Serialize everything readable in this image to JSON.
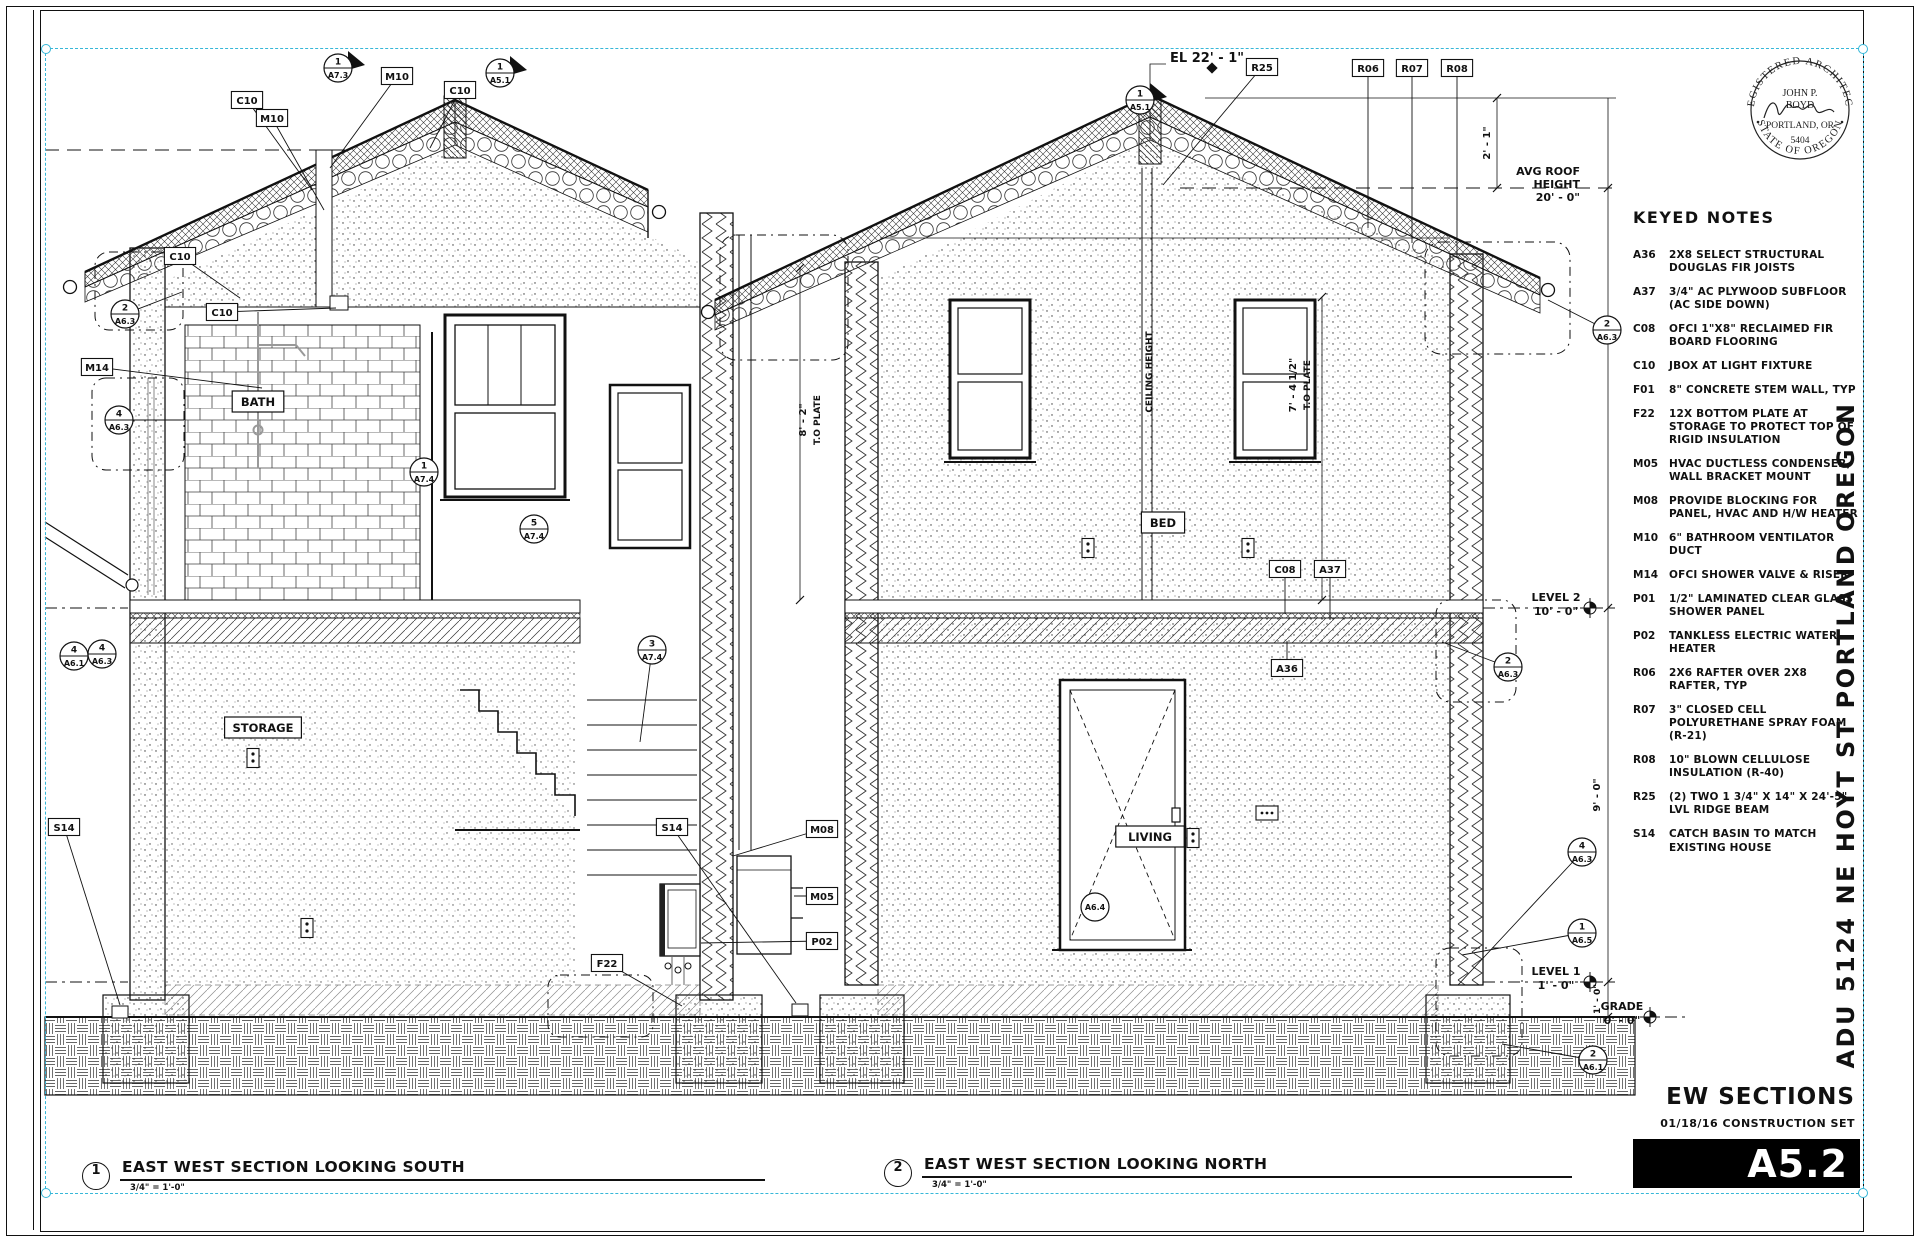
{
  "sheet": {
    "number": "A5.2",
    "title": "EW SECTIONS",
    "set_label": "01/18/16 CONSTRUCTION SET",
    "project_vertical": "ADU 5124 NE HOYT ST PORTLAND OREGON"
  },
  "stamp": {
    "arc_top": "REGISTERED ARCHITECT",
    "arc_bottom": "STATE OF OREGON",
    "name_line1": "JOHN P.",
    "name_line2": "BOYD",
    "city": "PORTLAND, OR",
    "license": "5404"
  },
  "keyed_notes": {
    "title": "KEYED NOTES",
    "notes": [
      {
        "code": "A36",
        "text": "2X8 SELECT STRUCTURAL DOUGLAS FIR JOISTS"
      },
      {
        "code": "A37",
        "text": "3/4\" AC PLYWOOD SUBFLOOR (AC SIDE DOWN)"
      },
      {
        "code": "C08",
        "text": "OFCI 1\"X8\" RECLAIMED FIR BOARD FLOORING"
      },
      {
        "code": "C10",
        "text": "JBOX AT LIGHT FIXTURE"
      },
      {
        "code": "F01",
        "text": "8\" CONCRETE STEM WALL, TYP"
      },
      {
        "code": "F22",
        "text": "12X BOTTOM PLATE AT STORAGE TO PROTECT TOP OF RIGID INSULATION"
      },
      {
        "code": "M05",
        "text": "HVAC DUCTLESS CONDENSER, WALL BRACKET MOUNT"
      },
      {
        "code": "M08",
        "text": "PROVIDE BLOCKING FOR PANEL, HVAC AND H/W HEATER"
      },
      {
        "code": "M10",
        "text": "6\" BATHROOM VENTILATOR DUCT"
      },
      {
        "code": "M14",
        "text": "OFCI SHOWER VALVE & RISER"
      },
      {
        "code": "P01",
        "text": "1/2\" LAMINATED CLEAR GLASS SHOWER PANEL"
      },
      {
        "code": "P02",
        "text": "TANKLESS ELECTRIC WATER HEATER"
      },
      {
        "code": "R06",
        "text": "2X6 RAFTER OVER 2X8 RAFTER, TYP"
      },
      {
        "code": "R07",
        "text": "3\" CLOSED CELL POLYURETHANE SPRAY FOAM (R-21)"
      },
      {
        "code": "R08",
        "text": "10\" BLOWN CELLULOSE INSULATION (R-40)"
      },
      {
        "code": "R25",
        "text": "(2) TWO 1 3/4\" X 14\" X 24'-5\" LVL RIDGE BEAM"
      },
      {
        "code": "S14",
        "text": "CATCH BASIN TO MATCH EXISTING HOUSE"
      }
    ]
  },
  "sections": [
    {
      "num": "1",
      "title": "EAST WEST SECTION LOOKING SOUTH",
      "scale": "3/4\" = 1'-0\""
    },
    {
      "num": "2",
      "title": "EAST WEST SECTION LOOKING NORTH",
      "scale": "3/4\" = 1'-0\""
    }
  ],
  "drawing": {
    "room_labels": [
      {
        "t": "BATH",
        "x": 258,
        "y": 402
      },
      {
        "t": "STORAGE",
        "x": 263,
        "y": 728
      },
      {
        "t": "BED",
        "x": 1163,
        "y": 523
      },
      {
        "t": "LIVING",
        "x": 1150,
        "y": 837
      }
    ],
    "tags": [
      {
        "t": "C10",
        "x": 247,
        "y": 100,
        "lx": 312,
        "ly": 190
      },
      {
        "t": "M10",
        "x": 272,
        "y": 118,
        "lx": 324,
        "ly": 210
      },
      {
        "t": "M10",
        "x": 397,
        "y": 76,
        "lx": 330,
        "ly": 168
      },
      {
        "t": "C10",
        "x": 460,
        "y": 90,
        "lx": 430,
        "ly": 148
      },
      {
        "t": "C10",
        "x": 180,
        "y": 256,
        "lx": 240,
        "ly": 298
      },
      {
        "t": "C10",
        "x": 222,
        "y": 312,
        "lx": 336,
        "ly": 308
      },
      {
        "t": "M14",
        "x": 97,
        "y": 367,
        "lx": 262,
        "ly": 388
      },
      {
        "t": "R25",
        "x": 1262,
        "y": 67,
        "lx": 1163,
        "ly": 185
      },
      {
        "t": "R06",
        "x": 1368,
        "y": 68,
        "lx": 1368,
        "ly": 228
      },
      {
        "t": "R07",
        "x": 1412,
        "y": 68,
        "lx": 1412,
        "ly": 243
      },
      {
        "t": "R08",
        "x": 1457,
        "y": 68,
        "lx": 1457,
        "ly": 258
      },
      {
        "t": "C08",
        "x": 1285,
        "y": 569,
        "lx": 1285,
        "ly": 614
      },
      {
        "t": "A37",
        "x": 1330,
        "y": 569,
        "lx": 1330,
        "ly": 620
      },
      {
        "t": "A36",
        "x": 1287,
        "y": 668,
        "lx": 1287,
        "ly": 641
      },
      {
        "t": "M08",
        "x": 822,
        "y": 829,
        "lx": 733,
        "ly": 856
      },
      {
        "t": "M05",
        "x": 822,
        "y": 896,
        "lx": 794,
        "ly": 896
      },
      {
        "t": "P02",
        "x": 822,
        "y": 941,
        "lx": 701,
        "ly": 943
      },
      {
        "t": "F22",
        "x": 607,
        "y": 963,
        "lx": 682,
        "ly": 1006
      },
      {
        "t": "S14",
        "x": 64,
        "y": 827,
        "lx": 120,
        "ly": 1005
      },
      {
        "t": "S14",
        "x": 672,
        "y": 827,
        "lx": 796,
        "ly": 1003
      }
    ],
    "markers": [
      {
        "n": "1",
        "s": "A7.3",
        "x": 338,
        "y": 68,
        "f": 1
      },
      {
        "n": "1",
        "s": "A5.1",
        "x": 500,
        "y": 73,
        "f": 1
      },
      {
        "n": "1",
        "s": "A5.1",
        "x": 1140,
        "y": 100,
        "f": 1
      },
      {
        "n": "2",
        "s": "A6.3",
        "x": 125,
        "y": 314,
        "lx": 182,
        "ly": 292
      },
      {
        "n": "4",
        "s": "A6.3",
        "x": 119,
        "y": 420,
        "lx": 184,
        "ly": 420
      },
      {
        "n": "4",
        "s": "A6.1",
        "x": 74,
        "y": 656
      },
      {
        "n": "4",
        "s": "A6.3",
        "x": 102,
        "y": 654
      },
      {
        "n": "1",
        "s": "A7.4",
        "x": 424,
        "y": 472
      },
      {
        "n": "5",
        "s": "A7.4",
        "x": 534,
        "y": 529
      },
      {
        "n": "3",
        "s": "A7.4",
        "x": 652,
        "y": 650,
        "lx": 640,
        "ly": 742
      },
      {
        "n": "2",
        "s": "A6.3",
        "x": 1607,
        "y": 330,
        "lx": 1548,
        "ly": 300
      },
      {
        "n": "2",
        "s": "A6.3",
        "x": 1508,
        "y": 667,
        "lx": 1442,
        "ly": 642
      },
      {
        "n": "4",
        "s": "A6.3",
        "x": 1582,
        "y": 852,
        "lx": 1458,
        "ly": 985
      },
      {
        "n": "1",
        "s": "A6.5",
        "x": 1582,
        "y": 933,
        "lx": 1462,
        "ly": 955
      },
      {
        "n": "2",
        "s": "A6.1",
        "x": 1593,
        "y": 1060,
        "lx": 1502,
        "ly": 1044
      },
      {
        "n": "",
        "s": "A6.4",
        "x": 1095,
        "y": 907
      }
    ],
    "texts": [
      {
        "t": "EL 22' - 1\"",
        "x": 1170,
        "y": 62,
        "a": "start",
        "z": 13
      },
      {
        "t": "AVG ROOF",
        "x": 1580,
        "y": 175,
        "a": "end",
        "z": 11
      },
      {
        "t": "HEIGHT",
        "x": 1580,
        "y": 188,
        "a": "end",
        "z": 11
      },
      {
        "t": "20' - 0\"",
        "x": 1580,
        "y": 201,
        "a": "end",
        "z": 11
      },
      {
        "t": "LEVEL 2",
        "x": 1556,
        "y": 601,
        "a": "middle",
        "z": 11
      },
      {
        "t": "10' - 0\"",
        "x": 1556,
        "y": 615,
        "a": "middle",
        "z": 11
      },
      {
        "t": "LEVEL 1",
        "x": 1556,
        "y": 975,
        "a": "middle",
        "z": 11
      },
      {
        "t": "1' - 0\"",
        "x": 1556,
        "y": 989,
        "a": "middle",
        "z": 11
      },
      {
        "t": "GRADE",
        "x": 1622,
        "y": 1010,
        "a": "middle",
        "z": 11
      },
      {
        "t": "0' - 0\"",
        "x": 1622,
        "y": 1024,
        "a": "middle",
        "z": 11
      }
    ],
    "vtexts": [
      {
        "t": "2' - 1\"",
        "x": 1490,
        "y": 143,
        "z": 10
      },
      {
        "t": "9' - 0\"",
        "x": 1600,
        "y": 795,
        "z": 10
      },
      {
        "t": "1' - 0\"",
        "x": 1600,
        "y": 999,
        "z": 9
      },
      {
        "t": "8' - 2\"",
        "x": 806,
        "y": 420,
        "z": 10
      },
      {
        "t": "T.O PLATE",
        "x": 820,
        "y": 420,
        "z": 9
      },
      {
        "t": "7' - 4 1/2\"",
        "x": 1296,
        "y": 385,
        "z": 10
      },
      {
        "t": "T.O PLATE",
        "x": 1310,
        "y": 385,
        "z": 9
      },
      {
        "t": "CEILING HEIGHT",
        "x": 1152,
        "y": 372,
        "z": 9
      }
    ],
    "outlets": [
      {
        "x": 253,
        "y": 758,
        "k": 2
      },
      {
        "x": 307,
        "y": 928,
        "k": 2
      },
      {
        "x": 1088,
        "y": 548,
        "k": 2
      },
      {
        "x": 1248,
        "y": 548,
        "k": 2
      },
      {
        "x": 1267,
        "y": 813,
        "k": 3
      },
      {
        "x": 1193,
        "y": 838,
        "k": 2
      }
    ],
    "colors": {
      "line": "#111111",
      "marquee": "#36b7d8",
      "paper": "#ffffff"
    }
  }
}
